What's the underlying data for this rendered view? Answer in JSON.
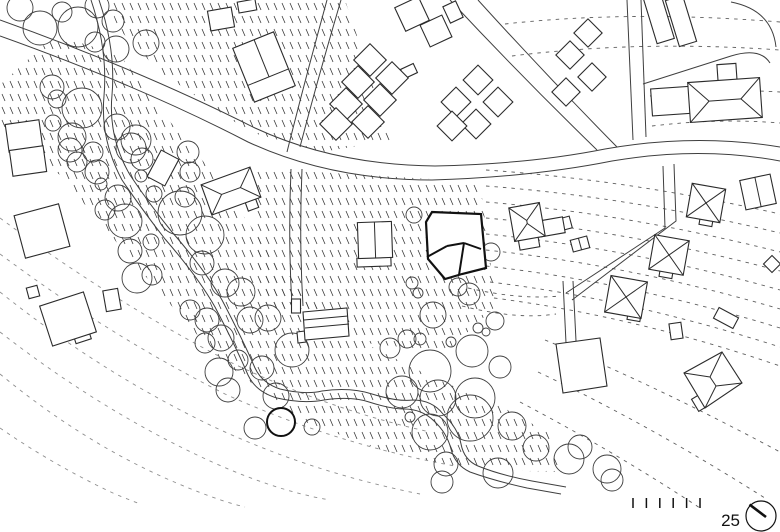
{
  "scale_bar": {
    "label": "25",
    "tick_count": 6,
    "tick_start_x": 633,
    "tick_spacing": 13.4,
    "tick_y": 498,
    "tick_height": 10,
    "label_x": 740,
    "label_y": 526
  },
  "north_symbol": {
    "cx": 761,
    "cy": 516,
    "r": 15,
    "needle": [
      749.5,
      504.5,
      766,
      517
    ]
  },
  "colors": {
    "line": "#3f3f3f",
    "building_stroke": "#2b2b2b",
    "building_fill": "#ffffff",
    "bold": "#111111",
    "contour": "#5f5f5f",
    "faint_contour": "#8f8f8f",
    "texture": "#3c3c3c",
    "background": "#ffffff"
  },
  "texture_regions": [
    {
      "points": "108,0 345,0 392,140 322,152 250,132 160,72 118,28"
    },
    {
      "points": "250,168 480,182 496,306 446,352 356,342 262,302"
    },
    {
      "points": "0,85 55,35 120,55 162,112 212,172 262,242 312,302 372,347 432,377 502,407 547,432 562,472 480,470 395,455 300,420 215,355 140,270 60,175 0,130"
    }
  ],
  "contours": [
    {
      "d": "M505,24 Q630,10 780,22"
    },
    {
      "d": "M512,56 Q640,40 780,50"
    },
    {
      "d": "M650,96 Q715,88 780,92"
    },
    {
      "d": "M652,126 Q718,118 780,123"
    },
    {
      "d": "M486,170 Q630,180 780,214"
    },
    {
      "d": "M486,186 Q630,197 780,233"
    },
    {
      "d": "M486,202 Q630,214 780,252"
    },
    {
      "d": "M486,218 Q630,231 780,271"
    },
    {
      "d": "M486,234 Q630,248 780,290"
    },
    {
      "d": "M486,250 Q630,265 780,309"
    },
    {
      "d": "M486,266 Q630,282 780,328"
    },
    {
      "d": "M490,282 Q630,299 780,347"
    },
    {
      "d": "M494,298 Q634,316 780,366"
    },
    {
      "d": "M545,340 Q655,385 780,452"
    },
    {
      "d": "M538,372 Q650,425 768,500"
    },
    {
      "d": "M520,402 Q615,452 700,508"
    },
    {
      "d": "M468,288 Q520,300 560,296"
    },
    {
      "d": "M462,306 Q518,320 556,314"
    },
    {
      "d": "M0,218 Q110,300 230,362 Q330,410 430,432",
      "faint": true
    },
    {
      "d": "M0,254 Q110,336 225,394 Q335,444 455,466",
      "faint": true
    },
    {
      "d": "M0,292 Q100,372 212,426 Q310,472 420,494",
      "faint": true
    },
    {
      "d": "M0,332 Q95,406 195,454 Q270,490 330,500",
      "faint": true
    },
    {
      "d": "M0,374 Q80,440 165,478 Q215,500 245,507",
      "faint": true
    },
    {
      "d": "M0,428 Q55,466 115,494 Q130,500 140,504",
      "faint": true
    }
  ],
  "roads": [
    {
      "d": "M0,20 Q140,70 255,128 Q335,165 435,166 Q530,164 605,149 Q695,133 780,147"
    },
    {
      "d": "M0,36 Q140,86 248,142 Q330,180 432,180 Q532,177 612,161 Q700,146 780,161"
    },
    {
      "d": "M287,152 Q305,80 327,0"
    },
    {
      "d": "M300,147 Q318,78 341,0"
    },
    {
      "d": "M291,169 Q288,240 292,306"
    },
    {
      "d": "M302,169 Q299,240 303,306"
    },
    {
      "d": "M627,0 L633,140"
    },
    {
      "d": "M641,0 L646,137"
    },
    {
      "d": "M450,0 Q520,75 597,150"
    },
    {
      "d": "M478,0 Q546,75 617,147"
    },
    {
      "d": "M663,166 L665,228 L566,293"
    },
    {
      "d": "M674,164 L676,221 L572,300"
    },
    {
      "d": "M563,281 L566,343"
    },
    {
      "d": "M573,281 L576,341"
    },
    {
      "d": "M99,0 Q116,50 112,95 Q108,137 130,175 Q150,205 172,232 Q205,270 222,300 Q243,340 255,368 Q262,383 280,389 Q305,395 322,391 Q350,387 372,394 Q398,402 413,400 Q432,400 443,414 Q458,428 461,444 Q464,460 478,466 Q500,475 532,481 L566,487"
    },
    {
      "d": "M91,0 Q108,50 104,96 Q100,139 122,180 Q143,211 165,239 Q198,277 215,307 Q236,347 248,375 Q256,392 277,398 Q303,404 324,400 Q351,396 369,402 Q391,409 404,409 Q422,409 434,421 Q447,433 451,449 Q455,465 470,472 Q495,481 527,488 L561,494"
    },
    {
      "d": "M731,2 Q772,10 776,47"
    },
    {
      "d": "M643,84 L731,56 Q760,47 770,63"
    }
  ],
  "trees": [
    [
      20,
      8,
      13
    ],
    [
      40,
      28,
      17
    ],
    [
      62,
      12,
      10
    ],
    [
      78,
      27,
      20
    ],
    [
      97,
      6,
      12
    ],
    [
      113,
      21,
      11
    ],
    [
      95,
      42,
      10
    ],
    [
      116,
      49,
      13
    ],
    [
      146,
      43,
      13
    ],
    [
      52,
      87,
      12
    ],
    [
      57,
      99,
      9
    ],
    [
      82,
      108,
      20
    ],
    [
      53,
      123,
      8
    ],
    [
      72,
      137,
      14
    ],
    [
      117,
      127,
      13
    ],
    [
      136,
      140,
      15
    ],
    [
      70,
      150,
      12
    ],
    [
      77,
      162,
      10
    ],
    [
      93,
      152,
      10
    ],
    [
      97,
      172,
      12
    ],
    [
      101,
      184,
      6
    ],
    [
      118,
      198,
      13
    ],
    [
      131,
      148,
      15
    ],
    [
      142,
      159,
      11
    ],
    [
      141,
      176,
      6
    ],
    [
      154,
      194,
      8
    ],
    [
      188,
      152,
      11
    ],
    [
      190,
      172,
      10
    ],
    [
      180,
      213,
      22
    ],
    [
      105,
      210,
      10
    ],
    [
      125,
      221,
      17
    ],
    [
      130,
      251,
      12
    ],
    [
      151,
      242,
      8
    ],
    [
      137,
      278,
      15
    ],
    [
      152,
      275,
      10
    ],
    [
      185,
      197,
      10
    ],
    [
      205,
      235,
      19
    ],
    [
      202,
      263,
      12
    ],
    [
      225,
      283,
      14
    ],
    [
      241,
      292,
      14
    ],
    [
      190,
      310,
      10
    ],
    [
      207,
      320,
      12
    ],
    [
      221,
      338,
      13
    ],
    [
      205,
      343,
      10
    ],
    [
      219,
      372,
      14
    ],
    [
      250,
      320,
      13
    ],
    [
      268,
      318,
      13
    ],
    [
      292,
      350,
      17
    ],
    [
      276,
      396,
      13
    ],
    [
      228,
      390,
      12
    ],
    [
      255,
      428,
      11
    ],
    [
      312,
      427,
      8
    ],
    [
      262,
      368,
      12
    ],
    [
      238,
      360,
      10
    ],
    [
      281,
      422,
      14,
      1
    ],
    [
      414,
      215,
      8
    ],
    [
      491,
      252,
      9
    ],
    [
      458,
      287,
      9
    ],
    [
      412,
      283,
      6
    ],
    [
      418,
      293,
      5
    ],
    [
      433,
      315,
      13
    ],
    [
      469,
      294,
      11
    ],
    [
      495,
      321,
      9
    ],
    [
      478,
      328,
      5
    ],
    [
      486,
      332,
      4
    ],
    [
      407,
      339,
      9
    ],
    [
      420,
      339,
      6
    ],
    [
      451,
      342,
      5
    ],
    [
      472,
      351,
      16
    ],
    [
      500,
      367,
      11
    ],
    [
      390,
      348,
      10
    ],
    [
      430,
      371,
      21
    ],
    [
      402,
      392,
      16
    ],
    [
      438,
      398,
      18
    ],
    [
      475,
      398,
      20
    ],
    [
      430,
      432,
      18
    ],
    [
      470,
      418,
      23
    ],
    [
      512,
      426,
      14
    ],
    [
      536,
      448,
      13
    ],
    [
      498,
      473,
      15
    ],
    [
      446,
      464,
      12
    ],
    [
      442,
      482,
      11
    ],
    [
      410,
      417,
      5
    ],
    [
      569,
      459,
      15
    ],
    [
      580,
      447,
      12
    ],
    [
      607,
      469,
      14
    ],
    [
      612,
      480,
      11
    ]
  ],
  "buildings": [
    {
      "r": [
        24,
        136,
        34,
        28,
        -8
      ]
    },
    {
      "r": [
        28,
        161,
        34,
        26,
        -8
      ]
    },
    {
      "r": [
        42,
        231,
        46,
        44,
        -15
      ]
    },
    {
      "r": [
        82,
        336,
        16,
        11,
        -18
      ]
    },
    {
      "r": [
        68,
        319,
        46,
        42,
        -18
      ]
    },
    {
      "r": [
        33,
        292,
        11,
        11,
        -15
      ]
    },
    {
      "r": [
        112,
        300,
        15,
        21,
        -10
      ]
    },
    {
      "r": [
        163,
        168,
        20,
        30,
        28
      ]
    },
    {
      "r": [
        221,
        19,
        24,
        20,
        -10
      ]
    },
    {
      "r": [
        247,
        6,
        18,
        11,
        -10
      ]
    },
    {
      "r": [
        264,
        67,
        44,
        58,
        -22
      ],
      "ll": [
        [
          1,
          -29,
          1,
          11
        ],
        [
          -22,
          11,
          22,
          11
        ]
      ]
    },
    {
      "r": [
        412,
        14,
        26,
        26,
        -25
      ]
    },
    {
      "r": [
        436,
        31,
        24,
        24,
        -25
      ]
    },
    {
      "r": [
        453,
        12,
        14,
        18,
        -25
      ]
    },
    {
      "r": [
        409,
        71,
        14,
        10,
        -25
      ]
    },
    {
      "r": [
        370,
        60,
        23,
        23,
        45
      ]
    },
    {
      "r": [
        392,
        78,
        23,
        23,
        45
      ]
    },
    {
      "r": [
        358,
        82,
        23,
        23,
        45
      ]
    },
    {
      "r": [
        380,
        100,
        23,
        23,
        45
      ]
    },
    {
      "r": [
        346,
        104,
        23,
        23,
        45
      ]
    },
    {
      "r": [
        368,
        122,
        23,
        23,
        45
      ]
    },
    {
      "r": [
        336,
        124,
        23,
        23,
        45
      ]
    },
    {
      "r": [
        478,
        80,
        21,
        21,
        45
      ]
    },
    {
      "r": [
        456,
        102,
        21,
        21,
        45
      ]
    },
    {
      "r": [
        498,
        102,
        21,
        21,
        45
      ]
    },
    {
      "r": [
        476,
        124,
        21,
        21,
        45
      ]
    },
    {
      "r": [
        452,
        126,
        21,
        21,
        45
      ]
    },
    {
      "r": [
        588,
        33,
        20,
        20,
        45
      ]
    },
    {
      "r": [
        570,
        55,
        20,
        20,
        45
      ]
    },
    {
      "r": [
        592,
        77,
        20,
        20,
        45
      ]
    },
    {
      "r": [
        566,
        92,
        20,
        20,
        45
      ]
    },
    {
      "r": [
        659,
        19,
        18,
        46,
        -17
      ]
    },
    {
      "r": [
        681,
        21,
        18,
        48,
        -17
      ]
    },
    {
      "r": [
        673,
        101,
        43,
        27,
        -4
      ]
    },
    {
      "r": [
        727,
        73,
        19,
        18,
        -4
      ]
    },
    {
      "r": [
        725,
        100,
        72,
        40,
        -4
      ],
      "roof": "hip"
    },
    {
      "r": [
        706,
        222,
        13,
        7,
        10
      ]
    },
    {
      "r": [
        706,
        203,
        34,
        34,
        10
      ],
      "roof": "x"
    },
    {
      "r": [
        666,
        274,
        13,
        7,
        10
      ]
    },
    {
      "r": [
        669,
        255,
        35,
        35,
        10
      ],
      "roof": "x"
    },
    {
      "r": [
        634,
        317,
        13,
        7,
        10
      ]
    },
    {
      "r": [
        626,
        297,
        37,
        37,
        10
      ],
      "roof": "x"
    },
    {
      "r": [
        758,
        192,
        31,
        30,
        -12
      ],
      "roof": "vsplit"
    },
    {
      "r": [
        580,
        244,
        17,
        12,
        -15
      ],
      "roof": "vsplit"
    },
    {
      "r": [
        563,
        224,
        16,
        12,
        -15
      ]
    },
    {
      "r": [
        551,
        227,
        26,
        16,
        -10
      ]
    },
    {
      "r": [
        529,
        243,
        20,
        11,
        -10
      ]
    },
    {
      "r": [
        527,
        222,
        31,
        34,
        -10
      ],
      "roof": "hip"
    },
    {
      "r": [
        374,
        262,
        34,
        9,
        -2
      ]
    },
    {
      "r": [
        375,
        240,
        34,
        36,
        -2
      ],
      "roof": "vsplit"
    },
    {
      "r": [
        252,
        205,
        11,
        9,
        -20
      ]
    },
    {
      "r": [
        231,
        191,
        52,
        32,
        -20
      ],
      "roof": "hip"
    },
    {
      "r": [
        296,
        306,
        9,
        14,
        0
      ]
    },
    {
      "p": [
        [
          297,
          332
        ],
        [
          305,
          331
        ],
        [
          306,
          342
        ],
        [
          298,
          343
        ]
      ]
    },
    {
      "p": [
        [
          303,
          312
        ],
        [
          347,
          308
        ],
        [
          349,
          336
        ],
        [
          305,
          340
        ]
      ],
      "l": [
        [
          304,
          320,
          348,
          316
        ],
        [
          305,
          328,
          349,
          324
        ]
      ]
    },
    {
      "r": [
        726,
        318,
        22,
        12,
        28
      ]
    },
    {
      "r": [
        676,
        331,
        12,
        16,
        -8
      ]
    },
    {
      "r": [
        772,
        264,
        12,
        12,
        45
      ]
    },
    {
      "p": [
        [
          556,
          344
        ],
        [
          600,
          338
        ],
        [
          607,
          386
        ],
        [
          563,
          393
        ]
      ]
    },
    {
      "r": [
        699,
        403,
        14,
        9,
        59
      ]
    },
    {
      "p": [
        [
          722,
          352
        ],
        [
          742,
          383
        ],
        [
          705,
          408
        ],
        [
          684,
          373
        ]
      ],
      "l": [
        [
          722,
          352,
          710,
          377
        ],
        [
          684,
          373,
          710,
          377
        ],
        [
          742,
          383,
          716,
          386
        ],
        [
          705,
          408,
          716,
          386
        ],
        [
          710,
          377,
          716,
          386
        ]
      ]
    },
    {
      "p": [
        [
          432,
          212
        ],
        [
          481,
          214
        ],
        [
          486,
          268
        ],
        [
          462,
          274
        ],
        [
          445,
          279
        ],
        [
          428,
          259
        ],
        [
          426,
          222
        ]
      ],
      "l": [
        [
          427,
          257,
          447,
          246
        ],
        [
          447,
          246,
          464,
          243
        ],
        [
          464,
          243,
          481,
          249
        ],
        [
          464,
          243,
          459,
          275
        ]
      ],
      "bold": true
    }
  ]
}
